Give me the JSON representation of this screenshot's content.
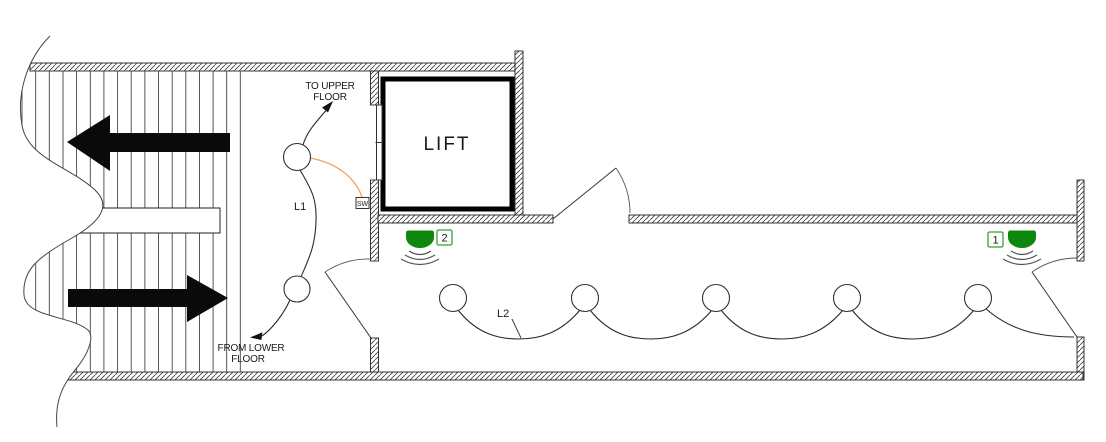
{
  "plan": {
    "annotations": {
      "to_upper_line1": "TO UPPER",
      "to_upper_line2": "FLOOR",
      "from_lower_line1": "FROM LOWER",
      "from_lower_line2": "FLOOR",
      "lift_label": "LIFT",
      "switch_label": "SW",
      "circuit_l1": "L1",
      "circuit_l2": "L2"
    },
    "sensors": [
      {
        "number": "1",
        "position": "corridor-right-end"
      },
      {
        "number": "2",
        "position": "corridor-left-end"
      }
    ],
    "fixtures": {
      "l1_lamp_count": 2,
      "l2_lamp_count": 5
    },
    "icons": {
      "motion_sensor": "pir-sensor-dome-with-waves",
      "stair_arrow_up": "solid-left-arrow",
      "stair_arrow_down": "solid-right-arrow",
      "flow_arrowheads": "small-filled-triangles"
    },
    "colors": {
      "sensor_green": "#0E870E",
      "badge_green": "#2FA32F",
      "wire_orange": "#F2A05F",
      "lift_text_gray": "#6F6F6F"
    }
  }
}
